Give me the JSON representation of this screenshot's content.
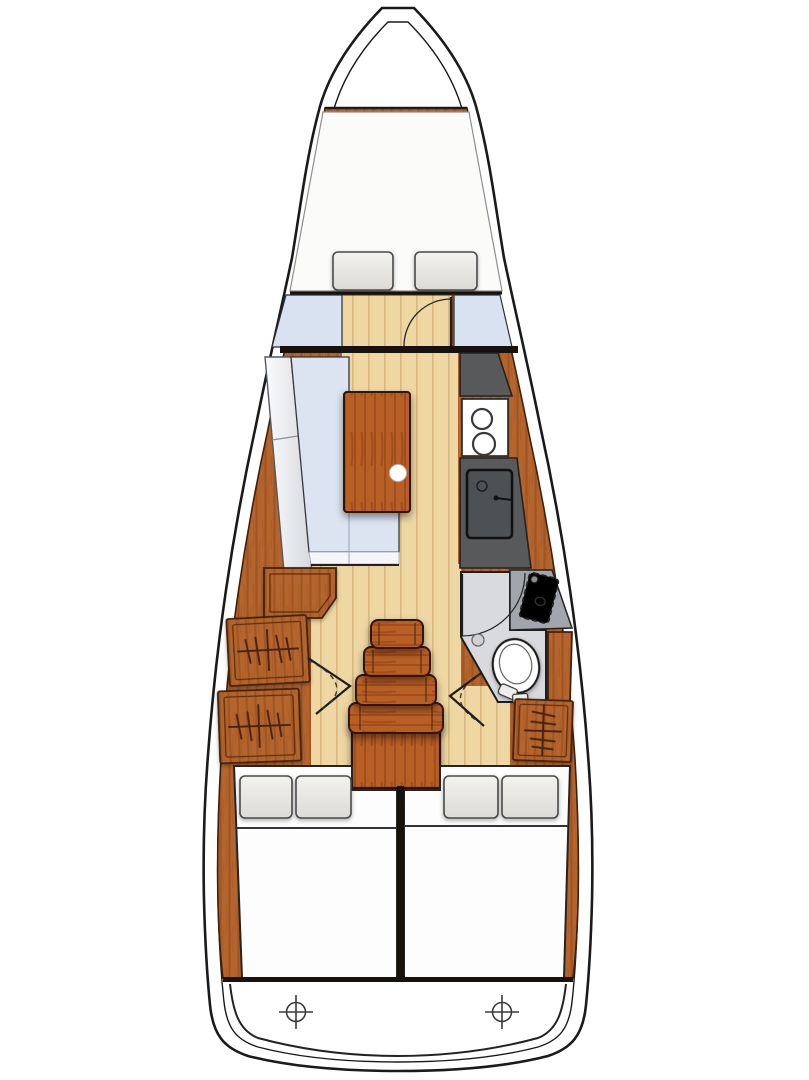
{
  "diagram": {
    "type": "boat-interior-floor-plan",
    "subject": "sailing-yacht-deck-layout",
    "orientation": "bow-up",
    "text_labels": []
  },
  "colors": {
    "hull-outline": "#1a1a1a",
    "deck": "#ffffff",
    "wood-base": "#b4652d",
    "wood-grain": "#a05423",
    "wood-edge": "#40200a",
    "wood-bright": "#b85f26",
    "wood-bright-grain": "#9c4817",
    "floor-base": "#eed7a2",
    "floor-plank": "#d8b981",
    "bulkhead": "#17120c",
    "settee-cushion": "#dce4f2",
    "settee-back": "#eef0f3",
    "fwd-panel": "#d8e2f0",
    "mattress": "#fbfbfa",
    "pillow": "#e9e8e4",
    "pillow-edge": "#4a4a4a",
    "counter-dark": "#58595b",
    "sink-basin": "#4e5154",
    "stove": "#ffffff",
    "head-floor": "#d9dadd",
    "head-counter": "#a2a6ac",
    "head-sink": "#67b6b",
    "toilet": "#ffffff",
    "symbol-dark": "#4b2409",
    "line-dark": "#222222"
  },
  "areas": {
    "forepeak": {
      "name": "anchor-locker",
      "contents": []
    },
    "v_berth": {
      "name": "v-berth",
      "pillows": 2,
      "mattress": 1
    },
    "forward_cabin": {
      "name": "forward-cabin",
      "door": "swing-arc",
      "side_panels": 2
    },
    "saloon": {
      "name": "saloon",
      "settee": "L-shaped",
      "table": 1,
      "table_handle_hole": 1,
      "seat_module": 1
    },
    "galley": {
      "name": "galley",
      "stove_burners": 2,
      "sink": 1,
      "faucet": 1,
      "counters": 2
    },
    "head": {
      "name": "head",
      "toilet": 1,
      "sink": 1,
      "door": "swing-arc",
      "floor_drain": 1
    },
    "companionway": {
      "name": "companionway",
      "steps": 4,
      "engine_box": 1,
      "cabin_doors": 2
    },
    "hanging_lockers": {
      "port": 2,
      "starboard": 1,
      "symbol": "clothes-rail-with-hangers"
    },
    "aft_cabins": {
      "count": 2,
      "pillows_per_berth": 2,
      "blanket_line": true,
      "center_divider": true
    },
    "transom": {
      "name": "transom",
      "rudder_stock_marks": 2,
      "mark_symbol": "crosshair-circle"
    }
  }
}
